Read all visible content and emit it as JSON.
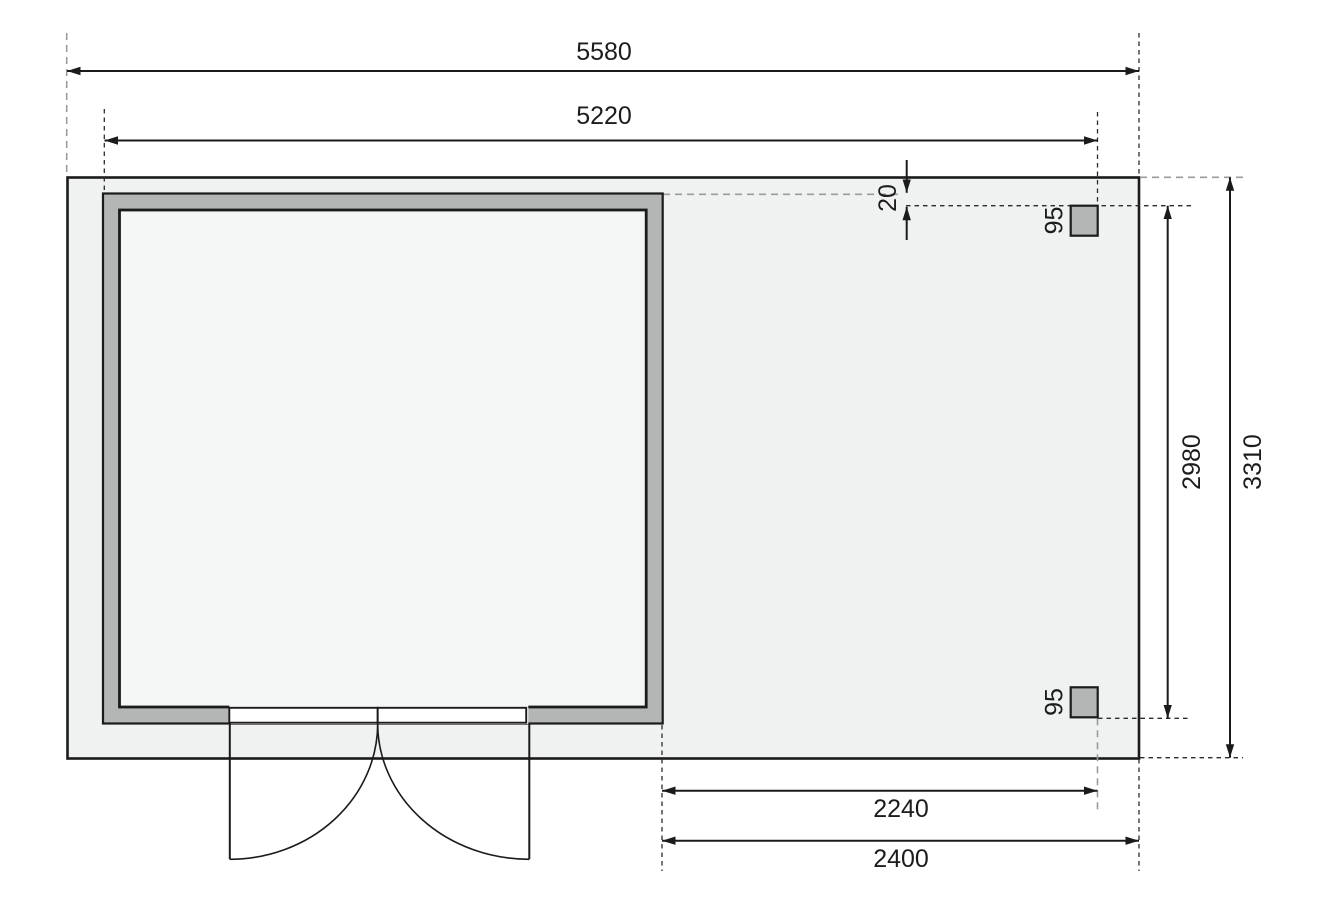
{
  "drawing": {
    "kind": "floor-plan dimension drawing",
    "dims": {
      "top_outer": "5580",
      "top_inner": "5220",
      "gap_small": "20",
      "post_top": "95",
      "post_bottom": "95",
      "right_inner": "2980",
      "right_outer": "3310",
      "bottom_inner": "2240",
      "bottom_outer": "2400"
    },
    "colors": {
      "line": "#1b1b1b",
      "dash_gray": "#9b9b9b",
      "wall": "#b4b6b6",
      "slab": "#f0f1f1",
      "interior": "#f5f6f6",
      "door_white": "#ffffff"
    }
  }
}
